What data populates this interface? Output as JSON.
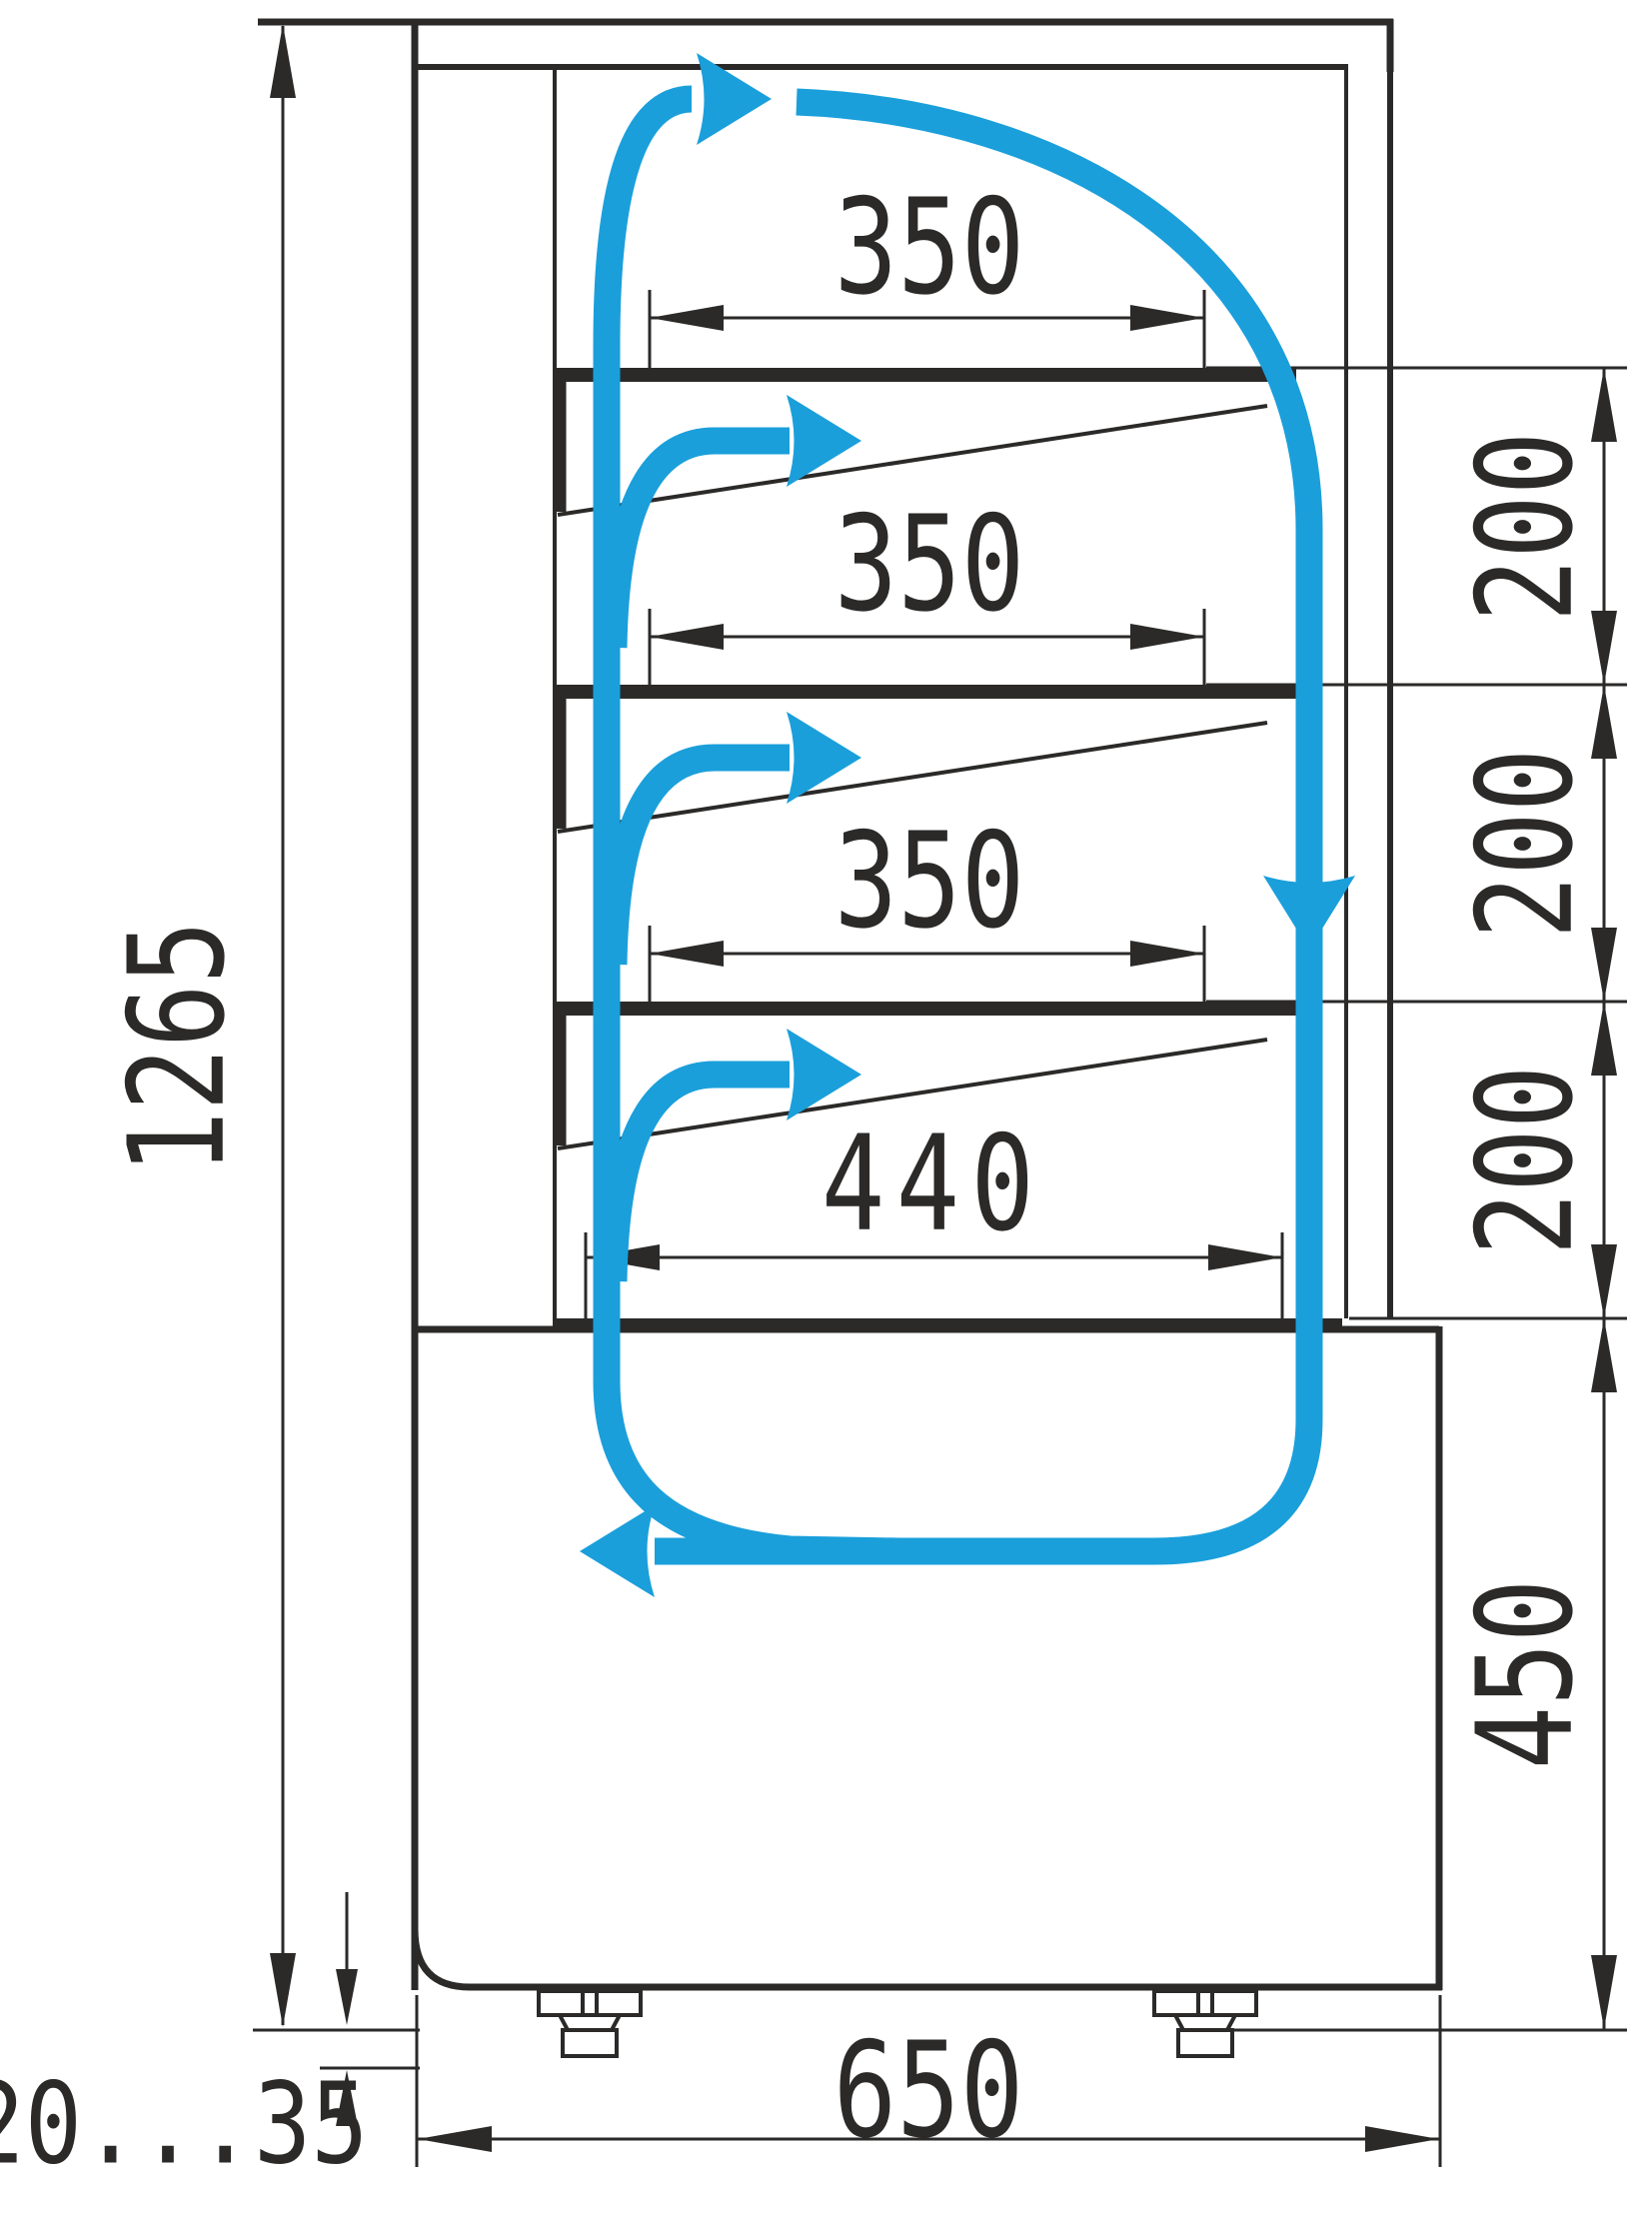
{
  "drawing": {
    "type": "refrigerated-display-case-airflow-scheme",
    "units": "mm"
  },
  "colors": {
    "line": "#2b2a29",
    "airflow": "#1a9fdb",
    "background": "#ffffff"
  },
  "dimensions": {
    "total_height": "1265",
    "shelf_width_1": "350",
    "shelf_width_2": "350",
    "shelf_width_3": "350",
    "bottom_shelf_width": "440",
    "shelf_gap_1": "200",
    "shelf_gap_2": "200",
    "shelf_gap_3": "200",
    "base_height": "450",
    "base_depth": "650",
    "leg_adjust_range": "20...35"
  }
}
